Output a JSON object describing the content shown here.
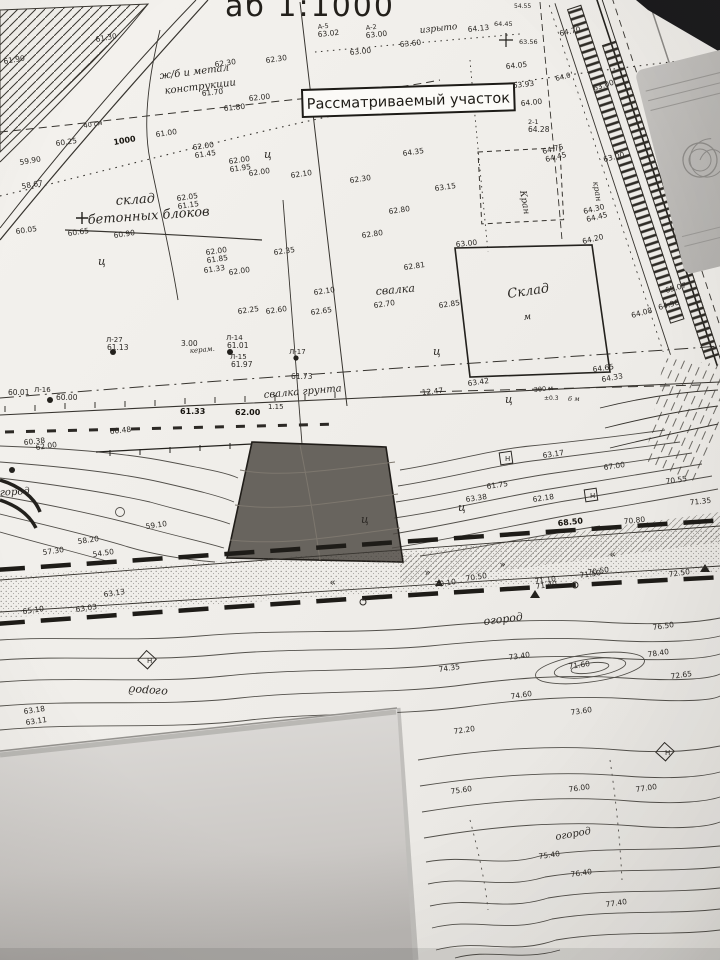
{
  "photo": {
    "background_color": "#1b1b1d",
    "paper_color": "#efede9",
    "overlap_sheet_color": "#d5d3d0",
    "desk_object_color": "#b9b7b4",
    "ink_color": "#2b2824"
  },
  "map": {
    "scale_title_partial": "аб 1:1000",
    "parcel_box_label": "Рассматриваемый участок",
    "highlight_color": "#504b45",
    "labels": [
      {
        "t": "61.30",
        "x": 96,
        "y": 42,
        "r": -10
      },
      {
        "t": "61.90",
        "x": 4,
        "y": 64,
        "r": -10
      },
      {
        "t": "62.30",
        "x": 215,
        "y": 67,
        "r": -8
      },
      {
        "t": "62.30",
        "x": 266,
        "y": 63,
        "r": -8
      },
      {
        "t": "А-5",
        "x": 318,
        "y": 29,
        "r": -6,
        "s": 6.5
      },
      {
        "t": "63.02",
        "x": 318,
        "y": 37,
        "r": -6
      },
      {
        "t": "А-2",
        "x": 366,
        "y": 30,
        "r": -6,
        "s": 6.5
      },
      {
        "t": "63.00",
        "x": 366,
        "y": 38,
        "r": -6
      },
      {
        "t": "63.60",
        "x": 400,
        "y": 47,
        "r": -6
      },
      {
        "t": "63.00",
        "x": 350,
        "y": 55,
        "r": -6
      },
      {
        "t": "изрыто",
        "x": 420,
        "y": 33,
        "r": -6,
        "s": 9,
        "f": "i"
      },
      {
        "t": "54.55",
        "x": 514,
        "y": 8,
        "s": 6
      },
      {
        "t": "64.45",
        "x": 494,
        "y": 26,
        "s": 6.5
      },
      {
        "t": "64.13",
        "x": 468,
        "y": 32,
        "r": -6
      },
      {
        "t": "64.70",
        "x": 560,
        "y": 36,
        "r": -12
      },
      {
        "t": "63.56",
        "x": 519,
        "y": 44,
        "s": 6.5
      },
      {
        "t": "64.05",
        "x": 506,
        "y": 69,
        "r": -6
      },
      {
        "t": "63.93",
        "x": 513,
        "y": 88,
        "r": -6
      },
      {
        "t": "64.00",
        "x": 521,
        "y": 106,
        "r": -6
      },
      {
        "t": "64.0",
        "x": 556,
        "y": 81,
        "r": -14,
        "s": 7
      },
      {
        "t": "2-1",
        "x": 528,
        "y": 124,
        "s": 6.5
      },
      {
        "t": "64.28",
        "x": 528,
        "y": 132
      },
      {
        "t": "62.00",
        "x": 249,
        "y": 101,
        "r": -6
      },
      {
        "t": "61.80",
        "x": 224,
        "y": 111,
        "r": -6
      },
      {
        "t": "61.70",
        "x": 202,
        "y": 96,
        "r": -6
      },
      {
        "t": "60.25",
        "x": 56,
        "y": 146,
        "r": -8
      },
      {
        "t": "61.00",
        "x": 156,
        "y": 137,
        "r": -8
      },
      {
        "t": "1000",
        "x": 114,
        "y": 145,
        "r": -10,
        "s": 8,
        "f": "b"
      },
      {
        "t": "40 см",
        "x": 84,
        "y": 128,
        "r": -10,
        "s": 6.5
      },
      {
        "t": "62.00",
        "x": 193,
        "y": 150,
        "r": -8
      },
      {
        "t": "61.45",
        "x": 195,
        "y": 158,
        "r": -8
      },
      {
        "t": "62.00",
        "x": 229,
        "y": 164,
        "r": -8
      },
      {
        "t": "61.95",
        "x": 230,
        "y": 172,
        "r": -8
      },
      {
        "t": "62.00",
        "x": 249,
        "y": 176,
        "r": -8
      },
      {
        "t": "62.10",
        "x": 291,
        "y": 178,
        "r": -8
      },
      {
        "t": "59.90",
        "x": 20,
        "y": 165,
        "r": -10
      },
      {
        "t": "58.67",
        "x": 22,
        "y": 189,
        "r": -10
      },
      {
        "t": "ж/б и метал",
        "x": 160,
        "y": 79,
        "r": -7,
        "s": 10,
        "f": "i"
      },
      {
        "t": "конструкции",
        "x": 165,
        "y": 94,
        "r": -7,
        "s": 10,
        "f": "i"
      },
      {
        "t": "склад",
        "x": 116,
        "y": 205,
        "r": -4,
        "s": 13,
        "f": "i"
      },
      {
        "t": "бетонных блоков",
        "x": 88,
        "y": 224,
        "r": -4,
        "s": 13,
        "f": "i"
      },
      {
        "t": "60.05",
        "x": 16,
        "y": 234,
        "r": -8
      },
      {
        "t": "60.65",
        "x": 68,
        "y": 236,
        "r": -8
      },
      {
        "t": "60.90",
        "x": 114,
        "y": 238,
        "r": -8
      },
      {
        "t": "62.05",
        "x": 177,
        "y": 201,
        "r": -8
      },
      {
        "t": "61.15",
        "x": 178,
        "y": 209,
        "r": -8
      },
      {
        "t": "62.00",
        "x": 206,
        "y": 255,
        "r": -8
      },
      {
        "t": "61.85",
        "x": 207,
        "y": 263,
        "r": -8
      },
      {
        "t": "61.33",
        "x": 204,
        "y": 273,
        "r": -8
      },
      {
        "t": "62.00",
        "x": 229,
        "y": 275,
        "r": -8
      },
      {
        "t": "62.35",
        "x": 274,
        "y": 255,
        "r": -8
      },
      {
        "t": "62.25",
        "x": 238,
        "y": 314,
        "r": -8
      },
      {
        "t": "62.60",
        "x": 266,
        "y": 314,
        "r": -8
      },
      {
        "t": "62.65",
        "x": 311,
        "y": 315,
        "r": -8
      },
      {
        "t": "62.10",
        "x": 314,
        "y": 295,
        "r": -8
      },
      {
        "t": "ц",
        "x": 264,
        "y": 158,
        "s": 11,
        "f": "i"
      },
      {
        "t": "ц",
        "x": 98,
        "y": 265,
        "s": 11,
        "f": "i"
      },
      {
        "t": "ц",
        "x": 433,
        "y": 355,
        "s": 11,
        "f": "i"
      },
      {
        "t": "ц",
        "x": 505,
        "y": 403,
        "s": 11,
        "f": "i"
      },
      {
        "t": "ц",
        "x": 458,
        "y": 511,
        "s": 11,
        "f": "i"
      },
      {
        "t": "ц",
        "x": 361,
        "y": 523,
        "s": 11,
        "f": "i"
      },
      {
        "t": "64.35",
        "x": 403,
        "y": 156,
        "r": -8
      },
      {
        "t": "62.30",
        "x": 350,
        "y": 183,
        "r": -8
      },
      {
        "t": "63.15",
        "x": 435,
        "y": 191,
        "r": -8
      },
      {
        "t": "62.80",
        "x": 389,
        "y": 214,
        "r": -8
      },
      {
        "t": "62.80",
        "x": 362,
        "y": 238,
        "r": -8
      },
      {
        "t": "62.81",
        "x": 404,
        "y": 270,
        "r": -8
      },
      {
        "t": "62.85",
        "x": 439,
        "y": 308,
        "r": -8
      },
      {
        "t": "62.70",
        "x": 374,
        "y": 308,
        "r": -8
      },
      {
        "t": "свалка",
        "x": 376,
        "y": 295,
        "r": -5,
        "s": 11,
        "f": "i"
      },
      {
        "t": "63.00",
        "x": 456,
        "y": 247,
        "r": -6
      },
      {
        "t": "64.30",
        "x": 584,
        "y": 214,
        "r": -14
      },
      {
        "t": "64.45",
        "x": 587,
        "y": 222,
        "r": -14
      },
      {
        "t": "64.20",
        "x": 583,
        "y": 244,
        "r": -14
      },
      {
        "t": "64.75",
        "x": 543,
        "y": 154,
        "r": -14
      },
      {
        "t": "64.45",
        "x": 546,
        "y": 162,
        "r": -14
      },
      {
        "t": "63.00",
        "x": 604,
        "y": 162,
        "r": -14
      },
      {
        "t": "63.00",
        "x": 594,
        "y": 91,
        "r": -18
      },
      {
        "t": "кран",
        "x": 593,
        "y": 182,
        "r": 80,
        "s": 8,
        "f": "i"
      },
      {
        "t": "Кран",
        "x": 520,
        "y": 191,
        "r": 80,
        "s": 9,
        "f": "i"
      },
      {
        "t": "Склад",
        "x": 508,
        "y": 298,
        "r": -8,
        "s": 13,
        "f": "i"
      },
      {
        "t": "м",
        "x": 524,
        "y": 320,
        "r": -8,
        "s": 9,
        "f": "i"
      },
      {
        "t": "Л-27",
        "x": 106,
        "y": 342,
        "s": 7
      },
      {
        "t": "61.13",
        "x": 107,
        "y": 350
      },
      {
        "t": "3.00",
        "x": 181,
        "y": 346
      },
      {
        "t": "керам.",
        "x": 190,
        "y": 353,
        "r": -5,
        "s": 7,
        "f": "i"
      },
      {
        "t": "Л-14",
        "x": 226,
        "y": 340,
        "s": 7
      },
      {
        "t": "61.01",
        "x": 227,
        "y": 348
      },
      {
        "t": "Л-15",
        "x": 230,
        "y": 359,
        "s": 7
      },
      {
        "t": "61.97",
        "x": 231,
        "y": 367
      },
      {
        "t": "Л-17",
        "x": 289,
        "y": 354,
        "s": 7
      },
      {
        "t": "61.73",
        "x": 291,
        "y": 379
      },
      {
        "t": "Л-16",
        "x": 34,
        "y": 392,
        "s": 7
      },
      {
        "t": "60.00",
        "x": 56,
        "y": 400
      },
      {
        "t": "60.01",
        "x": 8,
        "y": 395
      },
      {
        "t": "свалка грунта",
        "x": 264,
        "y": 398,
        "r": -5,
        "s": 10,
        "f": "i"
      },
      {
        "t": "1.15",
        "x": 268,
        "y": 409,
        "s": 7
      },
      {
        "t": "60.38",
        "x": 24,
        "y": 445,
        "r": -6
      },
      {
        "t": "60.48",
        "x": 110,
        "y": 434,
        "r": -6
      },
      {
        "t": "61.33",
        "x": 180,
        "y": 414,
        "s": 8,
        "f": "b"
      },
      {
        "t": "62.00",
        "x": 235,
        "y": 415,
        "s": 8,
        "f": "b"
      },
      {
        "t": "64.65",
        "x": 593,
        "y": 372,
        "r": -8
      },
      {
        "t": "63.42",
        "x": 468,
        "y": 386,
        "r": -8
      },
      {
        "t": "12.47",
        "x": 422,
        "y": 395,
        "r": -6
      },
      {
        "t": "300 м",
        "x": 534,
        "y": 392,
        "r": -6,
        "s": 6.5
      },
      {
        "t": "±0.3",
        "x": 544,
        "y": 400,
        "s": 6
      },
      {
        "t": "6 м",
        "x": 568,
        "y": 401,
        "s": 6.5,
        "f": "i"
      },
      {
        "t": "65.07",
        "x": 666,
        "y": 293,
        "r": -15
      },
      {
        "t": "64.98",
        "x": 659,
        "y": 310,
        "r": -15
      },
      {
        "t": "64.33",
        "x": 602,
        "y": 382,
        "r": -10
      },
      {
        "t": "64.08",
        "x": 632,
        "y": 318,
        "r": -15
      },
      {
        "t": "63.17",
        "x": 543,
        "y": 458,
        "r": -8
      },
      {
        "t": "61.75",
        "x": 487,
        "y": 489,
        "r": -8
      },
      {
        "t": "62.18",
        "x": 533,
        "y": 502,
        "r": -8
      },
      {
        "t": "63.38",
        "x": 466,
        "y": 502,
        "r": -8
      },
      {
        "t": "67.00",
        "x": 604,
        "y": 470,
        "r": -8
      },
      {
        "t": "70.55",
        "x": 666,
        "y": 484,
        "r": -8
      },
      {
        "t": "68.50",
        "x": 558,
        "y": 526,
        "r": -6,
        "s": 8,
        "f": "b"
      },
      {
        "t": "70.80",
        "x": 624,
        "y": 524,
        "r": -6
      },
      {
        "t": "71.35",
        "x": 690,
        "y": 505,
        "r": -6
      },
      {
        "t": "62.00",
        "x": 36,
        "y": 450,
        "r": -8
      },
      {
        "t": "58.20",
        "x": 78,
        "y": 544,
        "r": -8
      },
      {
        "t": "57.30",
        "x": 43,
        "y": 555,
        "r": -8
      },
      {
        "t": "54.50",
        "x": 93,
        "y": 557,
        "r": -8
      },
      {
        "t": "59.10",
        "x": 146,
        "y": 529,
        "r": -8
      },
      {
        "t": "огород",
        "x": -6,
        "y": 496,
        "r": -3,
        "s": 10,
        "f": "i"
      },
      {
        "t": "огород",
        "x": 168,
        "y": 689,
        "r": 184,
        "s": 11,
        "f": "i"
      },
      {
        "t": "огород",
        "x": 484,
        "y": 625,
        "r": -7,
        "s": 11,
        "f": "i"
      },
      {
        "t": "огород",
        "x": 556,
        "y": 840,
        "r": -10,
        "s": 10,
        "f": "i"
      },
      {
        "t": "70.10",
        "x": 435,
        "y": 587,
        "r": -8
      },
      {
        "t": "70.50",
        "x": 466,
        "y": 581,
        "r": -8
      },
      {
        "t": "71.10",
        "x": 535,
        "y": 584,
        "r": -8
      },
      {
        "t": "71.50",
        "x": 580,
        "y": 578,
        "r": -8
      },
      {
        "t": "70.50",
        "x": 588,
        "y": 575,
        "r": -8
      },
      {
        "t": "71.40",
        "x": 536,
        "y": 589,
        "r": -8
      },
      {
        "t": "72.50",
        "x": 669,
        "y": 577,
        "r": -8
      },
      {
        "t": "76.50",
        "x": 653,
        "y": 630,
        "r": -8
      },
      {
        "t": "78.40",
        "x": 648,
        "y": 657,
        "r": -8
      },
      {
        "t": "71.60",
        "x": 569,
        "y": 669,
        "r": -8
      },
      {
        "t": "73.40",
        "x": 509,
        "y": 660,
        "r": -8
      },
      {
        "t": "72.65",
        "x": 671,
        "y": 679,
        "r": -8
      },
      {
        "t": "74.60",
        "x": 511,
        "y": 699,
        "r": -8
      },
      {
        "t": "73.60",
        "x": 571,
        "y": 715,
        "r": -8
      },
      {
        "t": "72.20",
        "x": 454,
        "y": 734,
        "r": -8
      },
      {
        "t": "74.35",
        "x": 439,
        "y": 672,
        "r": -8
      },
      {
        "t": "65.10",
        "x": 23,
        "y": 614,
        "r": -8
      },
      {
        "t": "63.03",
        "x": 76,
        "y": 612,
        "r": -8
      },
      {
        "t": "63.13",
        "x": 104,
        "y": 597,
        "r": -8
      },
      {
        "t": "75.60",
        "x": 451,
        "y": 794,
        "r": -8
      },
      {
        "t": "76.00",
        "x": 569,
        "y": 792,
        "r": -8
      },
      {
        "t": "77.00",
        "x": 636,
        "y": 792,
        "r": -8
      },
      {
        "t": "75.40",
        "x": 539,
        "y": 859,
        "r": -8
      },
      {
        "t": "76.40",
        "x": 571,
        "y": 877,
        "r": -8
      },
      {
        "t": "77.40",
        "x": 606,
        "y": 907,
        "r": -8
      },
      {
        "t": "63.18",
        "x": 24,
        "y": 714,
        "r": -8
      },
      {
        "t": "63.11",
        "x": 26,
        "y": 725,
        "r": -8
      },
      {
        "t": "Н",
        "x": 505,
        "y": 461,
        "s": 7
      },
      {
        "t": "Н",
        "x": 590,
        "y": 498,
        "s": 7
      },
      {
        "t": "Н",
        "x": 147,
        "y": 663,
        "s": 7
      },
      {
        "t": "Н",
        "x": 665,
        "y": 755,
        "s": 7
      },
      {
        "t": "»",
        "x": 425,
        "y": 576,
        "r": -8,
        "s": 10
      },
      {
        "t": "»",
        "x": 500,
        "y": 568,
        "r": -8,
        "s": 10
      },
      {
        "t": "«",
        "x": 610,
        "y": 558,
        "r": -8,
        "s": 10
      },
      {
        "t": "«",
        "x": 330,
        "y": 586,
        "r": -8,
        "s": 10
      }
    ]
  }
}
